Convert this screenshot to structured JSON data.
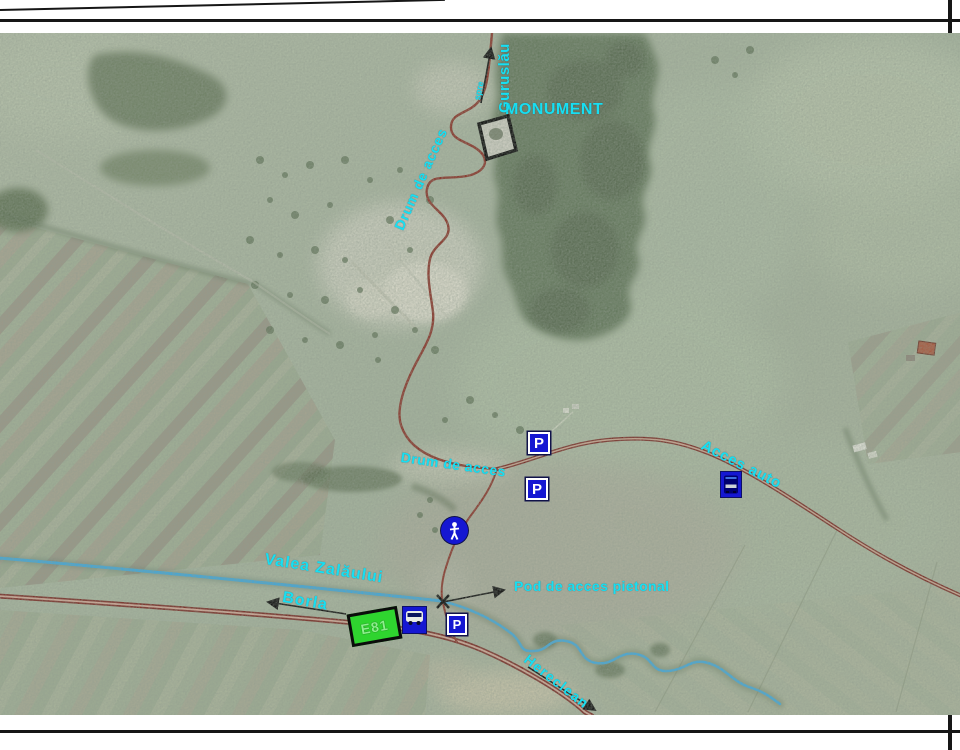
{
  "labels": {
    "monument": "MONUMENT",
    "direction_to": "spre",
    "direction_village": "Guruslău",
    "access_road_hill": "Drum de acces",
    "access_road_junction": "Drum de acces",
    "car_access": "Acces auto",
    "river": "Valea Zalăului",
    "village_west": "Borla",
    "village_southeast": "Hereclean",
    "footbridge": "Pod de acces pietonal"
  },
  "signs": {
    "european_route": "E81",
    "parking_letter": "P"
  },
  "icons": {
    "pedestrian": "walking-person",
    "bus_stop": "bus",
    "footbridge_marker": "x-cross",
    "monument_marker": "black-square"
  },
  "colors": {
    "label_cyan": "#17dff2",
    "road_red": "#7a2f28",
    "water_blue": "#42a7d8",
    "sign_blue": "#1517d2",
    "route_sign_green": "#2fd42f",
    "forest_green": "#66795d",
    "terrain_base": "#a7b29d",
    "frame_black": "#161616"
  }
}
